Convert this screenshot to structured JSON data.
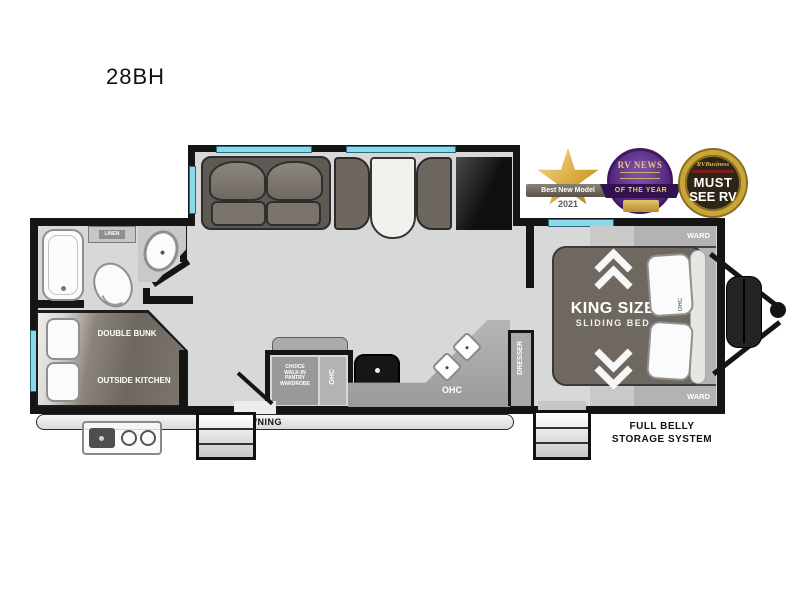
{
  "title": "28BH",
  "badges": {
    "best_new_model": {
      "ribbon": "Best New Model",
      "year": "2021"
    },
    "rv_news": {
      "brand": "RV NEWS",
      "ribbon": "OF THE YEAR"
    },
    "must_see_rv": {
      "brand": "RVBusiness",
      "line1": "MUST",
      "line2": "SEE RV"
    }
  },
  "floorplan": {
    "bathroom": {
      "linen": "LINEN"
    },
    "bunk": {
      "top": "DOUBLE BUNK",
      "bottom": "OUTSIDE KITCHEN"
    },
    "pantry": {
      "line1": "CHOICE",
      "line2": "WALK-IN",
      "line3": "PANTRY",
      "line4": "WARDROBE",
      "ohc": "OHC"
    },
    "kitchen": {
      "ohc": "OHC"
    },
    "bedroom": {
      "dresser": "DRESSER",
      "king_line1": "KING SIZE",
      "king_line2": "SLIDING BED",
      "ward_top": "WARD",
      "ward_bottom": "WARD",
      "ohc": "OHC"
    },
    "exterior": {
      "awning": "AWNING",
      "storage_line1": "FULL BELLY",
      "storage_line2": "STORAGE SYSTEM"
    }
  },
  "colors": {
    "wall": "#151515",
    "floor": "#d8d8d8",
    "window": "#8bd8ea",
    "furniture": "#6e6760",
    "counter": "#a6a6a6",
    "gold": "#d2a23d",
    "purple": "#54287c"
  }
}
